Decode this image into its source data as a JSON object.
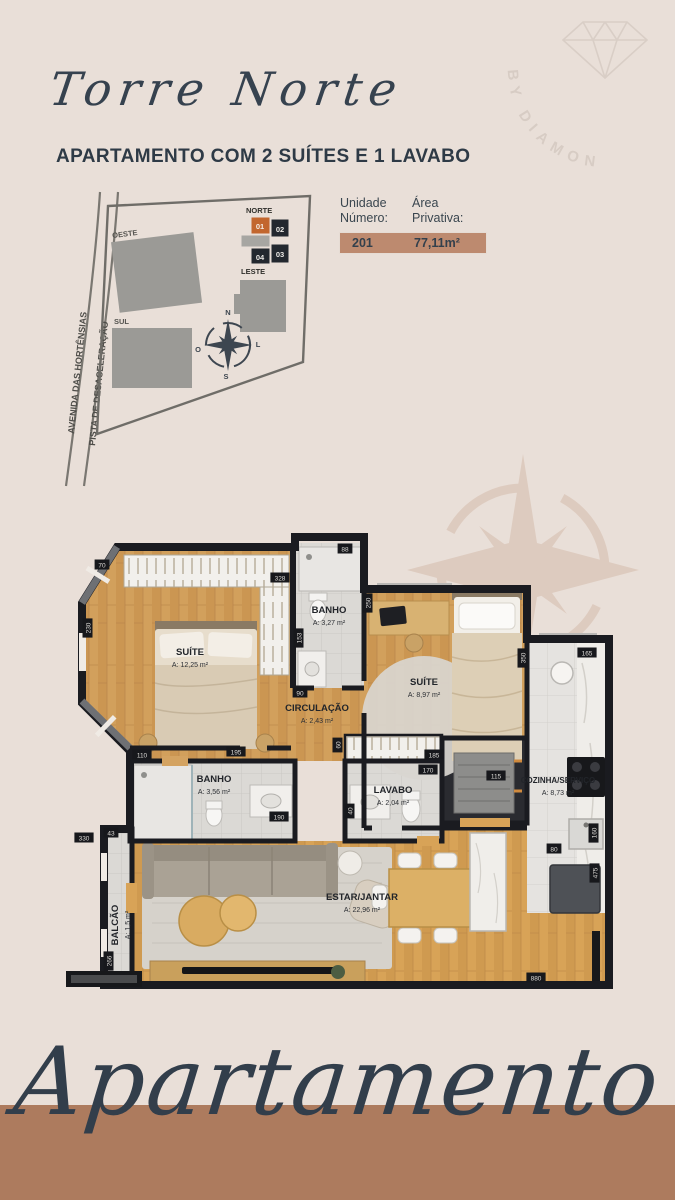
{
  "brand": {
    "watermark_text": "BY DIAMOND"
  },
  "header": {
    "tower_script": "Torre Norte",
    "subtitle": "APARTAMENTO COM 2 SUÍTES E 1 LAVABO"
  },
  "site_map": {
    "direction_labels": {
      "norte": "NORTE",
      "leste": "LESTE",
      "oeste": "OESTE",
      "sul": "SUL"
    },
    "street_labels": [
      "AVENIDA DAS HORTÊNSIAS",
      "PISTA DE DESACELERAÇÃO"
    ],
    "compass_points": {
      "n": "N",
      "l": "L",
      "o": "O",
      "s": "S"
    },
    "units": [
      {
        "label": "01",
        "highlighted": true
      },
      {
        "label": "02",
        "highlighted": false
      },
      {
        "label": "03",
        "highlighted": false
      },
      {
        "label": "04",
        "highlighted": false
      }
    ],
    "highlight_color": "#c2662e",
    "unit_dark_color": "#23282f"
  },
  "unit_info": {
    "col_unidade_line1": "Unidade",
    "col_unidade_line2": "Número:",
    "col_area_line1": "Área",
    "col_area_line2": "Privativa:",
    "unit_number": "201",
    "private_area": "77,11m²",
    "value_bar_color": "#bd8a6f"
  },
  "plan": {
    "rooms": [
      {
        "name": "SUÍTE",
        "area": "A: 12,25 m²",
        "x": 128,
        "y": 122
      },
      {
        "name": "BANHO",
        "area": "A: 3,27 m²",
        "x": 267,
        "y": 80
      },
      {
        "name": "SUÍTE",
        "area": "A: 8,97 m²",
        "x": 362,
        "y": 152
      },
      {
        "name": "CIRCULAÇÃO",
        "area": "A: 2,43 m²",
        "x": 255,
        "y": 178
      },
      {
        "name": "BANHO",
        "area": "A: 3,56 m²",
        "x": 152,
        "y": 249
      },
      {
        "name": "LAVABO",
        "area": "A: 2,04 m²",
        "x": 331,
        "y": 260
      },
      {
        "name": "COZINHA/SERVIÇO",
        "area": "A: 8,73 m²",
        "x": 496,
        "y": 250
      },
      {
        "name": "ESTAR/JANTAR",
        "area": "A: 22,96 m²",
        "x": 300,
        "y": 367
      },
      {
        "name": "BALCÃO",
        "area": "A: 1,5 m²",
        "x": 56,
        "y": 392,
        "rot": true
      }
    ],
    "dimensions": [
      {
        "v": "328",
        "x": 218,
        "y": 45
      },
      {
        "v": "230",
        "x": 26,
        "y": 95,
        "rot": true
      },
      {
        "v": "70",
        "x": 40,
        "y": 32
      },
      {
        "v": "88",
        "x": 283,
        "y": 16
      },
      {
        "v": "250",
        "x": 306,
        "y": 70,
        "rot": true
      },
      {
        "v": "153",
        "x": 237,
        "y": 105,
        "rot": true
      },
      {
        "v": "90",
        "x": 238,
        "y": 160
      },
      {
        "v": "110",
        "x": 80,
        "y": 222
      },
      {
        "v": "195",
        "x": 174,
        "y": 219
      },
      {
        "v": "60",
        "x": 276,
        "y": 212,
        "rot": true
      },
      {
        "v": "185",
        "x": 372,
        "y": 222
      },
      {
        "v": "170",
        "x": 366,
        "y": 237
      },
      {
        "v": "115",
        "x": 434,
        "y": 243
      },
      {
        "v": "40",
        "x": 288,
        "y": 278,
        "rot": true
      },
      {
        "v": "190",
        "x": 217,
        "y": 284
      },
      {
        "v": "43",
        "x": 49,
        "y": 300
      },
      {
        "v": "330",
        "x": 22,
        "y": 305
      },
      {
        "v": "266",
        "x": 47,
        "y": 428,
        "rot": true
      },
      {
        "v": "880",
        "x": 474,
        "y": 445
      },
      {
        "v": "165",
        "x": 525,
        "y": 120
      },
      {
        "v": "350",
        "x": 461,
        "y": 125,
        "rot": true
      },
      {
        "v": "80",
        "x": 492,
        "y": 316
      },
      {
        "v": "160",
        "x": 532,
        "y": 300,
        "rot": true
      },
      {
        "v": "475",
        "x": 533,
        "y": 340,
        "rot": true
      }
    ]
  },
  "footer": {
    "script_text": "Apartamento"
  }
}
